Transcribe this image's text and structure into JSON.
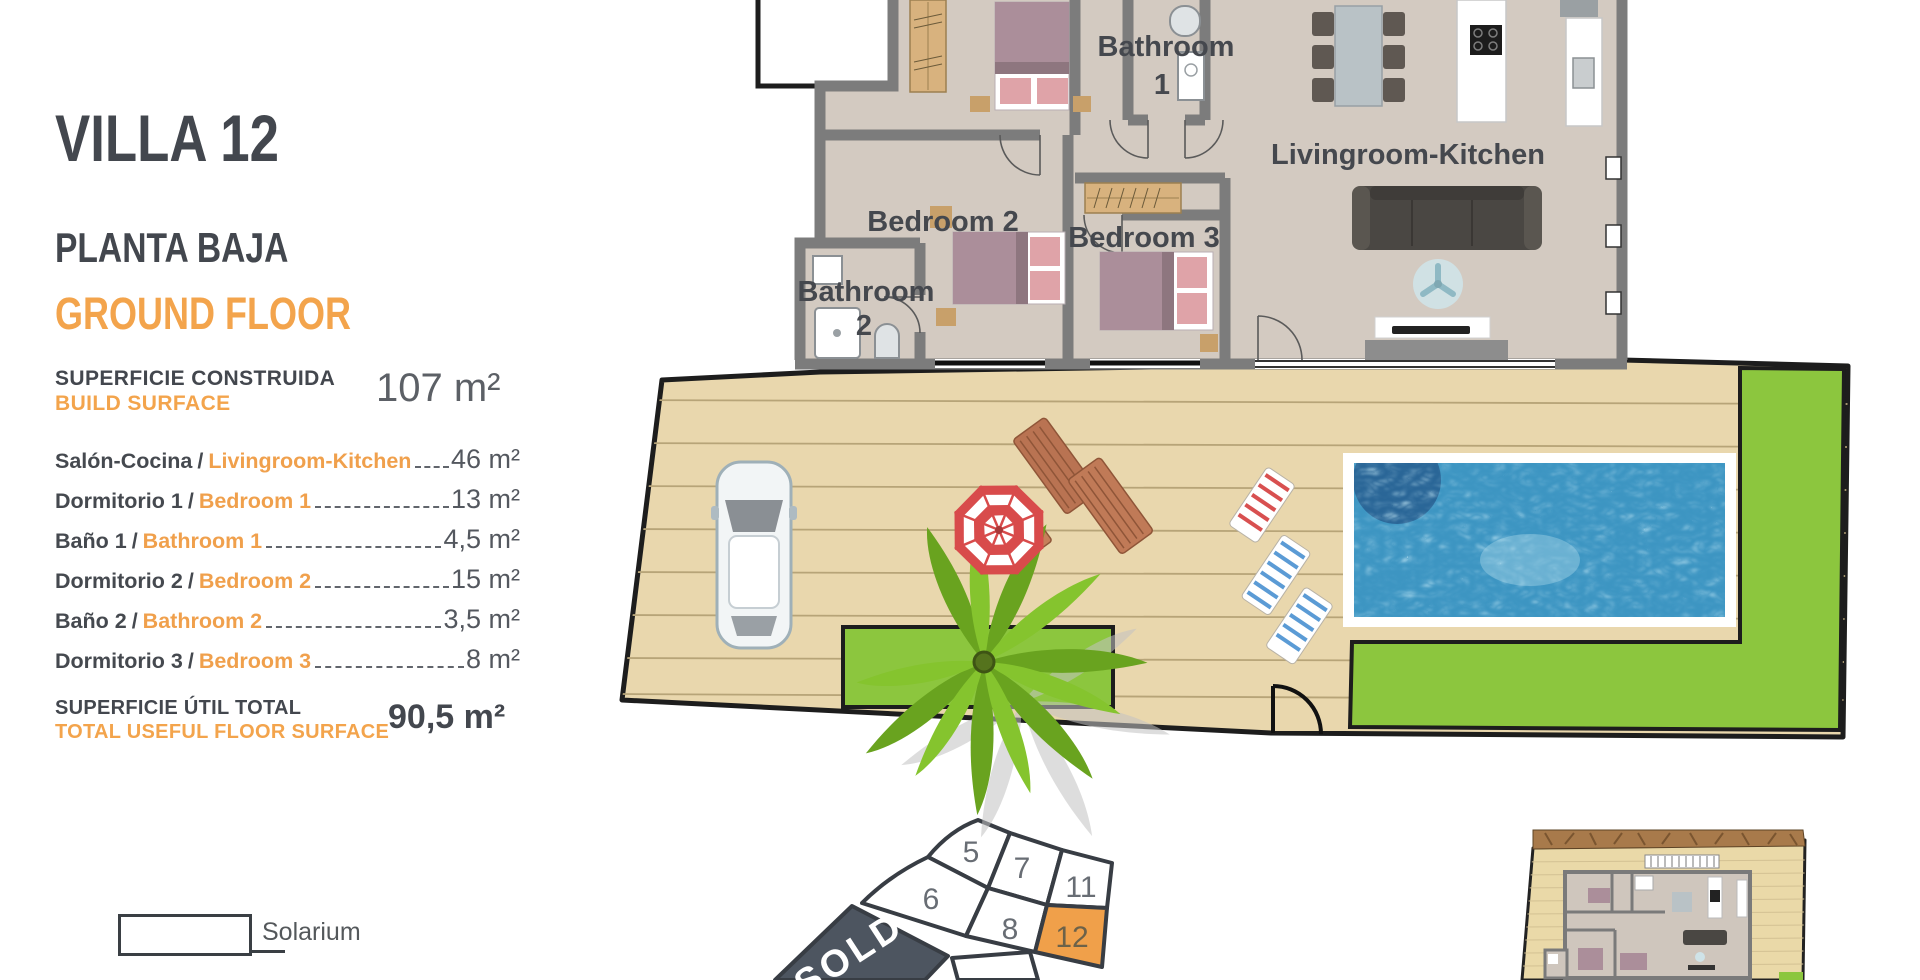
{
  "panel": {
    "title": "VILLA 12",
    "subtitle_es": "PLANTA BAJA",
    "subtitle_en": "GROUND FLOOR",
    "build_surface": {
      "label_es": "SUPERFICIE CONSTRUIDA",
      "label_en": "BUILD SURFACE",
      "value": "107 m²"
    },
    "rooms": [
      {
        "es": "Salón-Cocina",
        "en": "Livingroom-Kitchen",
        "value": "46 m²"
      },
      {
        "es": "Dormitorio 1",
        "en": "Bedroom 1",
        "value": "13 m²"
      },
      {
        "es": "Baño 1",
        "en": "Bathroom 1",
        "value": "4,5 m²"
      },
      {
        "es": "Dormitorio 2",
        "en": "Bedroom 2",
        "value": "15 m²"
      },
      {
        "es": "Baño 2",
        "en": "Bathroom 2",
        "value": "3,5 m²"
      },
      {
        "es": "Dormitorio 3",
        "en": "Bedroom 3",
        "value": "8 m²"
      }
    ],
    "total": {
      "label_es": "SUPERFICIE ÚTIL TOTAL",
      "label_en": "TOTAL USEFUL FLOOR SURFACE",
      "value": "90,5 m²"
    },
    "legend": {
      "solarium": "Solarium"
    }
  },
  "floorplan": {
    "room_labels": {
      "bathroom1_line1": "Bathroom",
      "bathroom1_line2": "1",
      "living": "Livingroom-Kitchen",
      "bedroom2": "Bedroom 2",
      "bedroom3": "Bedroom 3",
      "bathroom2_line1": "Bathroom",
      "bathroom2_line2": "2"
    }
  },
  "site_map": {
    "plots": [
      "5",
      "7",
      "11",
      "6",
      "8",
      "12",
      "9"
    ],
    "sold_label": "SOLD",
    "highlighted_plot": "12"
  },
  "colors": {
    "accent_orange": "#F3A44C",
    "ink": "#43474E",
    "plot_highlight": "#F0A04A",
    "sold_fill": "#4D5560",
    "lawn": "#8CC63E",
    "pool_water": "#3D95C2",
    "deck": "#E9D7AD",
    "wall_gray": "#7C7C7C",
    "floor": "#D3CAC1"
  }
}
